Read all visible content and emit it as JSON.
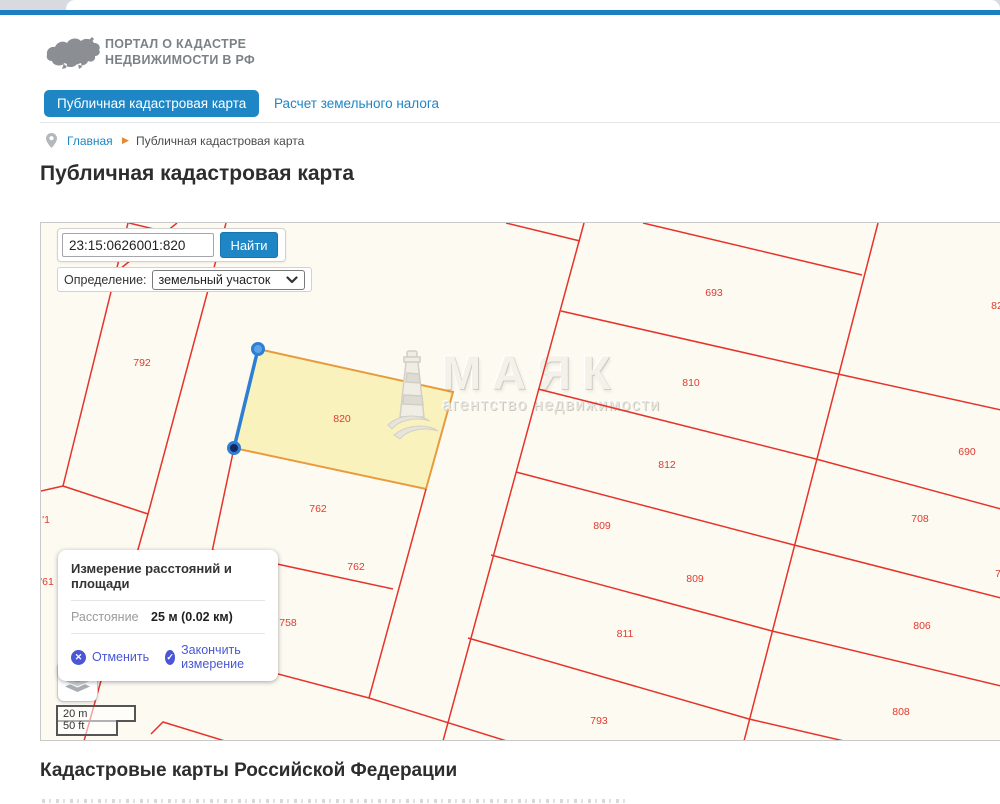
{
  "header": {
    "logo_line1": "ПОРТАЛ О КАДАСТРЕ",
    "logo_line2": "НЕДВИЖИМОСТИ В РФ",
    "tabs": [
      {
        "label": "Публичная кадастровая карта",
        "active": true
      },
      {
        "label": "Расчет земельного налога",
        "active": false
      }
    ],
    "breadcrumb": {
      "home": "Главная",
      "separator": "▶",
      "current": "Публичная кадастровая карта"
    }
  },
  "page": {
    "title": "Публичная кадастровая карта",
    "footer_heading": "Кадастровые карты Российской Федерации"
  },
  "map": {
    "search": {
      "value": "23:15:0626001:820",
      "button": "Найти"
    },
    "definition": {
      "label": "Определение:",
      "selected": "земельный участок"
    },
    "measure_popup": {
      "title": "Измерение расстояний и площади",
      "distance_label": "Расстояние",
      "distance_value": "25 м (0.02 км)",
      "cancel_icon": "✕",
      "cancel": "Отменить",
      "finish_icon": "✓",
      "finish": "Закончить измерение"
    },
    "scale": {
      "metric": "20 m",
      "imperial": "50 ft"
    },
    "watermark": {
      "title": "МАЯК",
      "subtitle": "агентство недвижимости"
    },
    "colors": {
      "boundary_line": "#e5332b",
      "selected_fill": "#f9f0b4",
      "selected_stroke": "#e89b3c",
      "measure_line": "#2e7ed4",
      "accent_blue": "#1e86c5"
    },
    "parcels": {
      "labels": [
        {
          "text": "792",
          "x": 101,
          "y": 140
        },
        {
          "text": "820",
          "x": 301,
          "y": 196
        },
        {
          "text": "693",
          "x": 673,
          "y": 70
        },
        {
          "text": "810",
          "x": 650,
          "y": 160
        },
        {
          "text": "812",
          "x": 626,
          "y": 242
        },
        {
          "text": "690",
          "x": 926,
          "y": 229
        },
        {
          "text": "82",
          "x": 956,
          "y": 83
        },
        {
          "text": "762",
          "x": 277,
          "y": 286
        },
        {
          "text": "762",
          "x": 315,
          "y": 344
        },
        {
          "text": "758",
          "x": 247,
          "y": 400
        },
        {
          "text": "809",
          "x": 561,
          "y": 303
        },
        {
          "text": "809",
          "x": 654,
          "y": 356
        },
        {
          "text": "811",
          "x": 584,
          "y": 411
        },
        {
          "text": "793",
          "x": 558,
          "y": 498
        },
        {
          "text": "708",
          "x": 879,
          "y": 296
        },
        {
          "text": "806",
          "x": 881,
          "y": 403
        },
        {
          "text": "808",
          "x": 860,
          "y": 489
        },
        {
          "text": "7",
          "x": 957,
          "y": 351
        },
        {
          "text": "'1",
          "x": 5,
          "y": 297
        },
        {
          "text": "'61",
          "x": 6,
          "y": 359
        }
      ]
    },
    "geometry": {
      "width": 959,
      "height": 518,
      "lines": [
        [
          87,
          0,
          22,
          263
        ],
        [
          22,
          263,
          0,
          268
        ],
        [
          22,
          263,
          107,
          291
        ],
        [
          185,
          0,
          107,
          291,
          43,
          518
        ],
        [
          193,
          225,
          150,
          428
        ],
        [
          171,
          327,
          352,
          366
        ],
        [
          150,
          428,
          328,
          475,
          472,
          520
        ],
        [
          110,
          511,
          122,
          499,
          197,
          522
        ],
        [
          385,
          266,
          328,
          475
        ],
        [
          543,
          0,
          402,
          518
        ],
        [
          837,
          0,
          703,
          518
        ],
        [
          602,
          0,
          821,
          52
        ],
        [
          520,
          88,
          797,
          151,
          960,
          187
        ],
        [
          497,
          166,
          775,
          236,
          960,
          286
        ],
        [
          475,
          249,
          753,
          322,
          960,
          375
        ],
        [
          450,
          332,
          731,
          408,
          960,
          463
        ],
        [
          427,
          415,
          708,
          496,
          803,
          518
        ],
        [
          465,
          0,
          539,
          18
        ],
        [
          136,
          0,
          74,
          50
        ],
        [
          88,
          0,
          179,
          22
        ]
      ],
      "selected_parcel": [
        217,
        126,
        412,
        169,
        385,
        266,
        193,
        225
      ],
      "measure_line": [
        217,
        126,
        193,
        225
      ],
      "measure_markers": [
        {
          "x": 217,
          "y": 126,
          "fill": "#5ea3e8"
        },
        {
          "x": 193,
          "y": 225,
          "fill": "#16295a"
        }
      ]
    }
  }
}
